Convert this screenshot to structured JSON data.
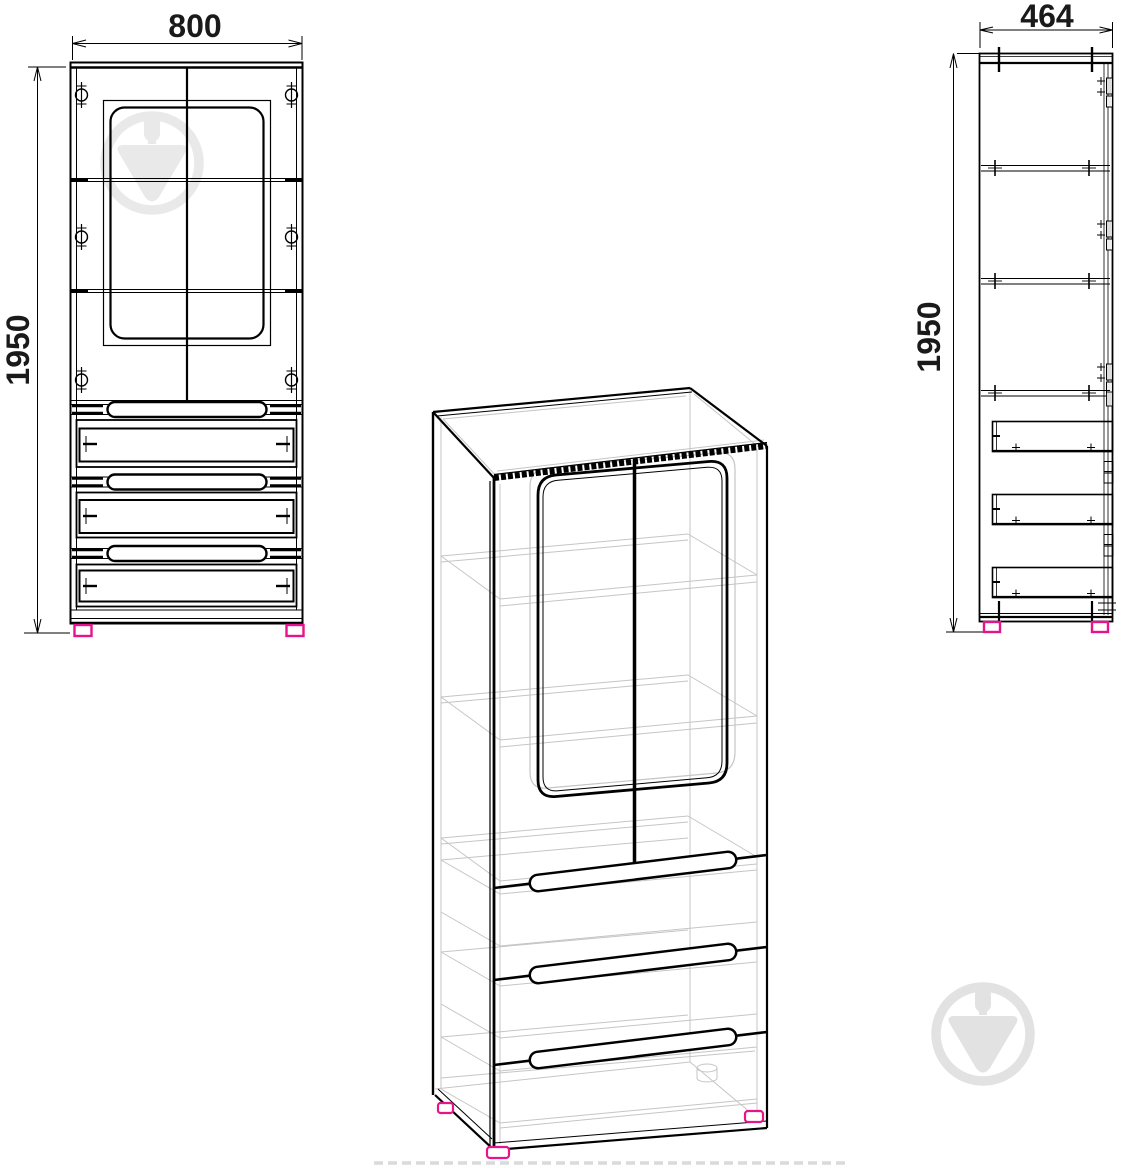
{
  "drawing": {
    "title": "wardrobe-technical-drawing",
    "views": {
      "front": {
        "width_mm": "800",
        "height_mm": "1950"
      },
      "side": {
        "depth_mm": "464",
        "height_mm": "1950"
      },
      "isometric": {}
    },
    "colors": {
      "line": "#000000",
      "hidden_line": "#c5c5c5",
      "feet_accent": "#e6138b",
      "watermark_light": "#e9e9e9",
      "watermark_dark": "#e2e2e2",
      "ghost_dash": "#dadada"
    },
    "icons": {
      "watermark": "trowel-in-circle-icon"
    }
  }
}
